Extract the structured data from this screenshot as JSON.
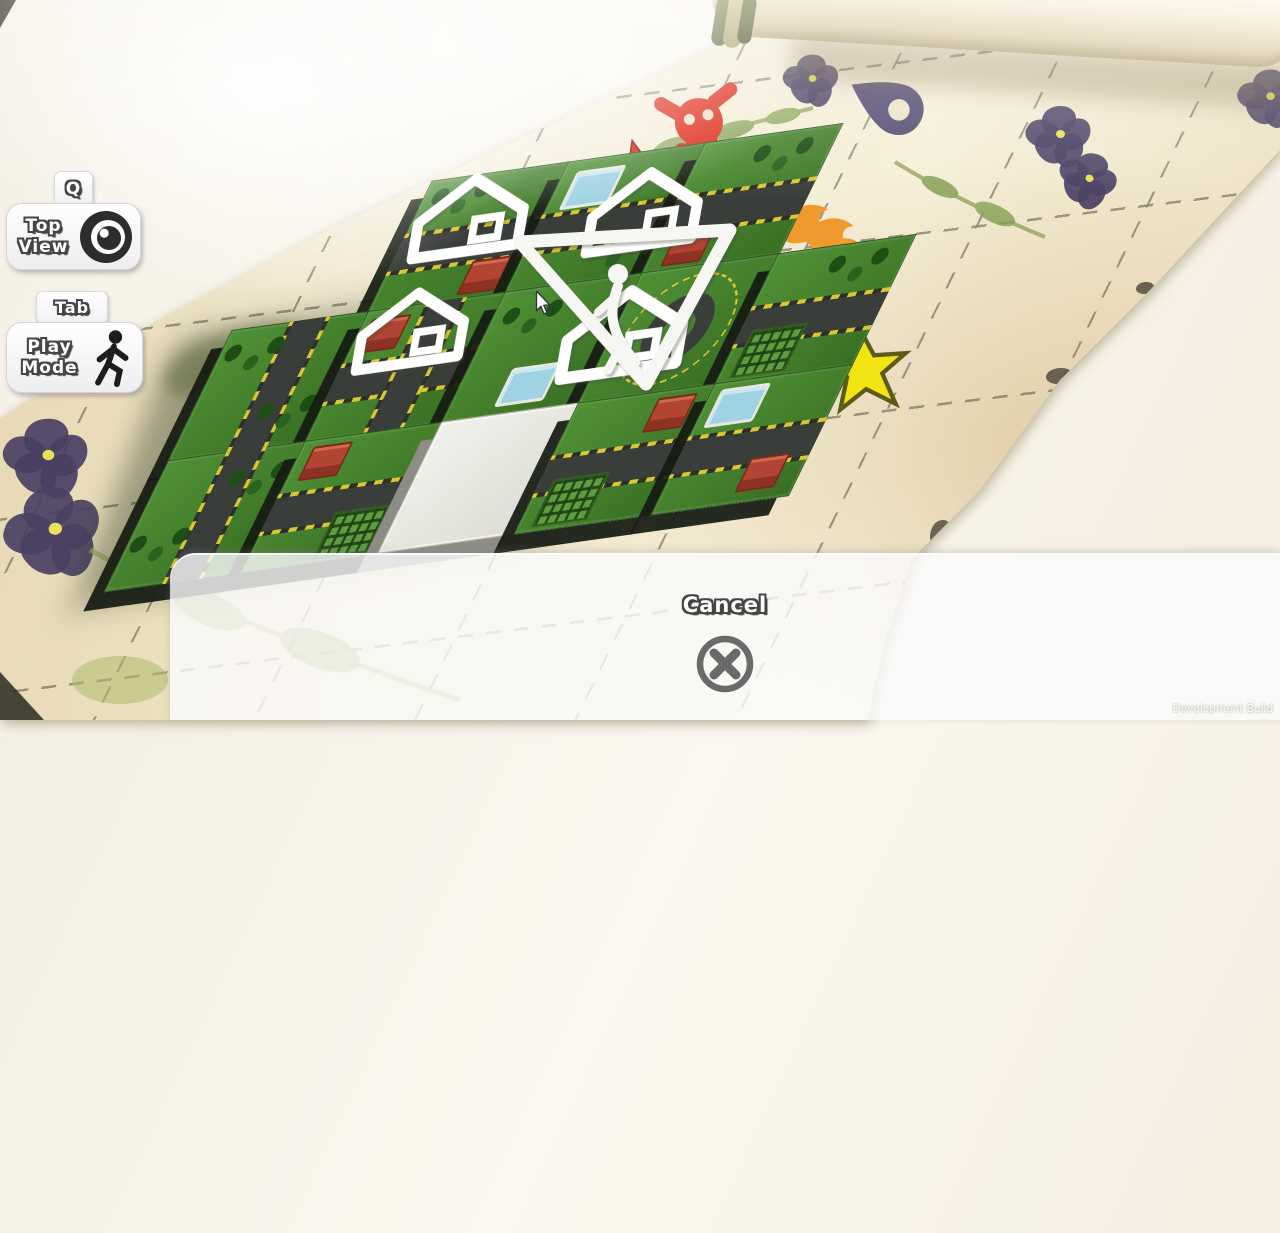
{
  "window": {
    "watermark": "Development Build"
  },
  "hud": {
    "top_view": {
      "key": "Q",
      "line1": "Top",
      "line2": "View",
      "icon": "eye-icon"
    },
    "play_mode": {
      "key": "Tab",
      "line1": "Play",
      "line2": "Mode",
      "icon": "walking-person-icon"
    }
  },
  "cancel_panel": {
    "label": "Cancel",
    "icon": "cancel-x-icon"
  },
  "map": {
    "surface": "parchment-scroll",
    "decals": [
      "skull-crossbones",
      "red-star",
      "small-yellow-star",
      "large-yellow-star",
      "location-pin",
      "flame",
      "pressed-pansy-flowers",
      "pressed-leaf-sprigs"
    ],
    "markers": [
      "house-marker",
      "house-marker",
      "house-marker",
      "house-marker",
      "pedestrian-triangle-marker"
    ],
    "tiles": "city-block-tiles"
  },
  "colors": {
    "parchment": "#efe3c6",
    "decal_red": "#dd2512",
    "decal_yellow": "#f2e412",
    "decal_orange": "#f09a2e",
    "decal_purple": "#564d73",
    "tile_green": "#47862f",
    "road_gray": "#3a3e3a",
    "panel_white": "rgba(251,251,252,0.8)",
    "icon_gray": "#6a6a6a"
  }
}
